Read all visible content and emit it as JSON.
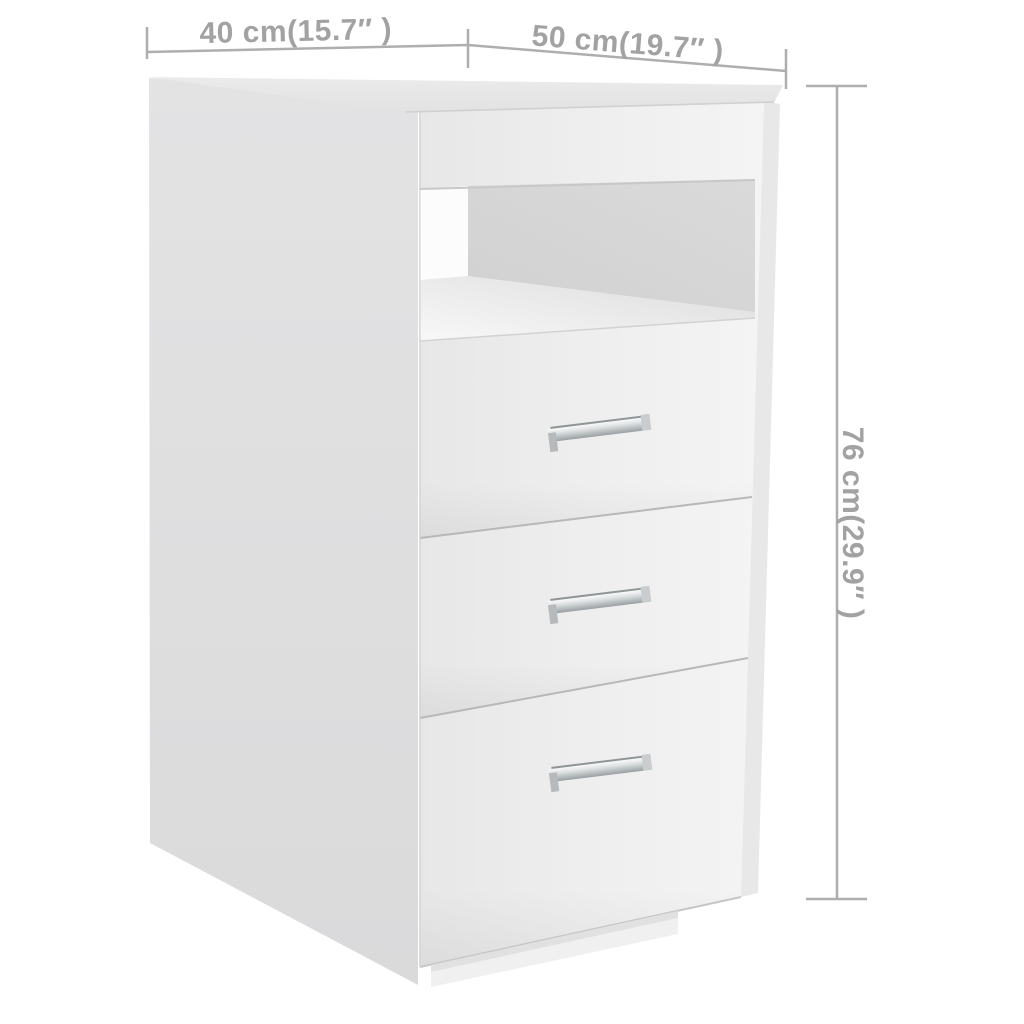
{
  "page": {
    "background": "#ffffff",
    "description": "Product dimension diagram of a white cabinet with one open shelf compartment and three drawers"
  },
  "dimensions": {
    "line_color": "#aeaeae",
    "text_color": "#a2a2a2",
    "depth": {
      "label": "40 cm(15.7″ )",
      "cm": "40",
      "inches": "15.7"
    },
    "width": {
      "label": "50 cm(19.7″ )",
      "cm": "50",
      "inches": "19.7"
    },
    "height": {
      "label": "76 cm(29.9″ )",
      "cm": "76",
      "inches": "29.9"
    }
  },
  "cabinet": {
    "colors": {
      "side_panel": "#dedede",
      "front_face": "#efefef",
      "top_board": "#e7e7e8",
      "right_edge": "#e8e8e9",
      "niche_back_wall": "#d6d6d6",
      "niche_left_wall": "#fcfcfc",
      "niche_floor": "#ececec",
      "plinth": "#f0f0f0",
      "gap_line": "#b8b8b8",
      "edge_line": "#c6c6c6",
      "handle_metal": "#c3c7c9"
    },
    "features": {
      "drawers": "3",
      "open_shelves": "1",
      "handles": "3"
    }
  }
}
